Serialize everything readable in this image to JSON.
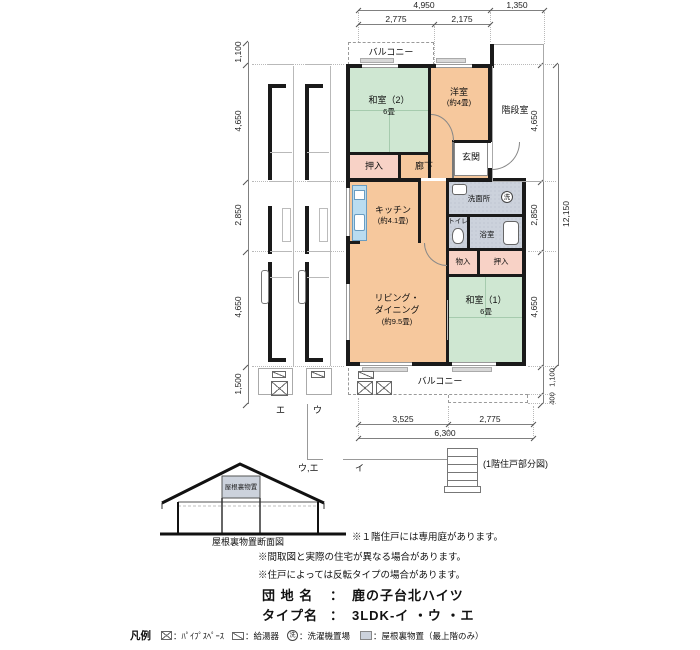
{
  "plan": {
    "balcony_top_label": "バルコニー",
    "balcony_bottom_label": "バルコニー",
    "stairwell_label": "階段室",
    "laundry_mark": "洗",
    "rooms": {
      "washitsu2_name": "和室（2）",
      "washitsu2_size": "6畳",
      "youshitsu_name": "洋室",
      "youshitsu_size": "(約4畳)",
      "oshiire_top": "押入",
      "rouka": "廊下",
      "genkan": "玄関",
      "kitchen_name": "キッチン",
      "kitchen_size": "(約4.1畳)",
      "senmenjo": "洗面所",
      "toilet": "トイレ",
      "bath": "浴室",
      "monoire": "物入",
      "oshiire_bottom": "押入",
      "living_name1": "リビング・",
      "living_name2": "ダイニング",
      "living_size": "(約9.5畳)",
      "washitsu1_name": "和室（1）",
      "washitsu1_size": "6畳"
    },
    "unit_e": "エ",
    "unit_u": "ウ",
    "unit_ue": "ウ,エ",
    "unit_i": "イ",
    "first_floor_caption": "(1階住戸部分図)"
  },
  "dims": {
    "top_total": "4,950",
    "top_stair": "1,350",
    "top_left": "2,775",
    "top_right": "2,175",
    "left_balcony": "1,100",
    "left_upper": "4,650",
    "left_middle": "2,850",
    "left_lower": "4,650",
    "left_bottom": "1,500",
    "right_upper": "4,650",
    "right_middle": "2,850",
    "right_lower": "4,650",
    "right_total": "12,150",
    "right_balcony": "1,100",
    "right_step": "400",
    "bottom_left": "3,525",
    "bottom_right": "2,775",
    "bottom_total": "6,300"
  },
  "section": {
    "attic_label": "屋根裏物置",
    "caption": "屋根裏物置断面図"
  },
  "notes": {
    "garden": "※１階住戸には専用庭があります。",
    "difference": "※間取図と実際の住宅が異なる場合があります。",
    "mirrored": "※住戸によっては反転タイプの場合があります。"
  },
  "info": {
    "estate_label": "団 地 名",
    "estate_sep": "：",
    "estate_name": "鹿の子台北ハイツ",
    "type_label": "タイプ名",
    "type_sep": "：",
    "type_name": "3LDK-イ ・ウ ・エ"
  },
  "legend": {
    "title": "凡例",
    "pipe_label": "：ﾊﾟｲﾌﾟｽﾍﾟｰｽ",
    "heater_label": "：給湯器",
    "laundry_mark": "洗",
    "laundry_label": "：洗濯機置場",
    "attic_label": "：屋根裏物置（最上階のみ）"
  }
}
